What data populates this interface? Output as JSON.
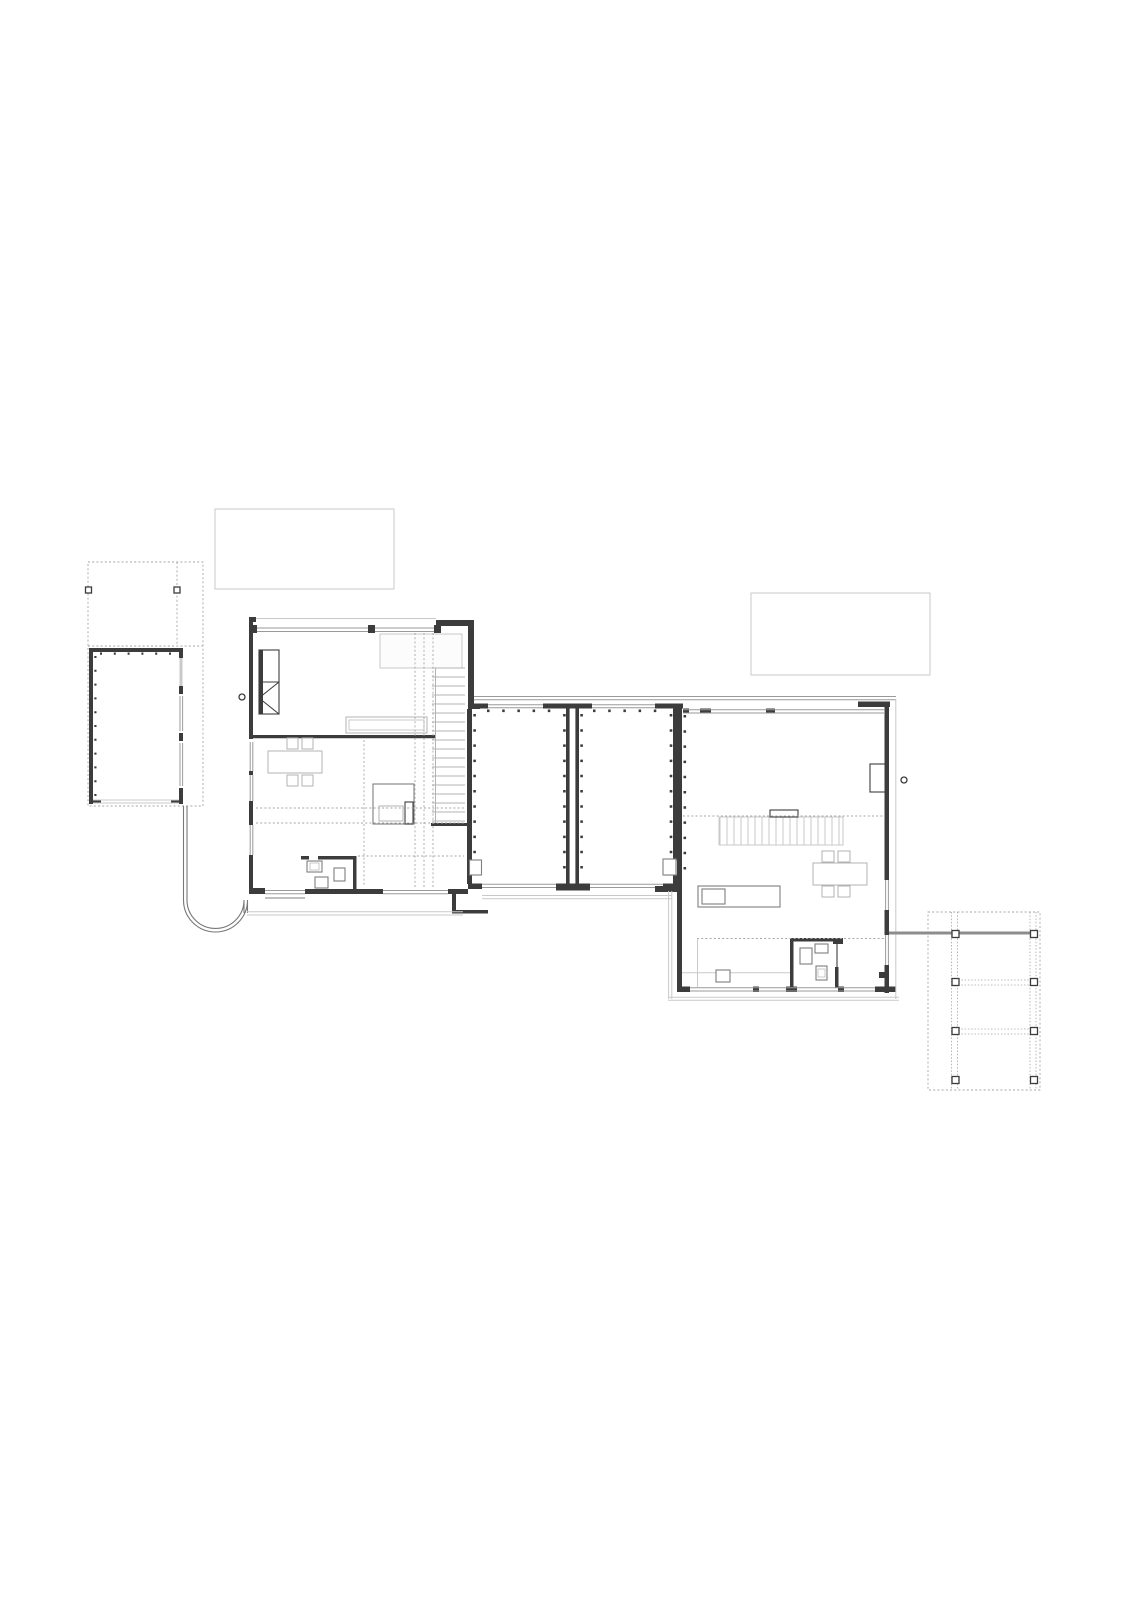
{
  "document": {
    "kind": "architectural-floor-plan",
    "sheet": {
      "width_px": 1131,
      "height_px": 1600,
      "background": "#ffffff"
    },
    "visible_text": []
  },
  "colors": {
    "paper": "#ffffff",
    "wall_dark": "#3c3c3c",
    "wall_medium": "#7f7f7f",
    "glazing": "#9a9a9a",
    "furniture": "#b3b3b3",
    "hairline": "#c9c9c9",
    "dotted": "#a6a6a6",
    "beam": "#8c8c8c",
    "void_fill": "#fcfcfc"
  },
  "plan_elements": {
    "site_structures": [
      {
        "name": "carport-left",
        "style": "dotted canopy outline",
        "posts": 2
      },
      {
        "name": "garage",
        "style": "solid walls with stud ticks",
        "openings": "glazed east side, light south door"
      },
      {
        "name": "curved-garden-wall",
        "style": "u-shaped double line linking garage to west house"
      },
      {
        "name": "roof-rectangle-upper-left",
        "style": "light empty rectangle"
      },
      {
        "name": "roof-rectangle-upper-right",
        "style": "light empty rectangle"
      },
      {
        "name": "pergola-right",
        "style": "dotted canopy outline",
        "posts": 8,
        "beam_to_house": true
      }
    ],
    "buildings": [
      {
        "name": "west-house",
        "features": [
          "fireplace",
          "void-opening",
          "staircase-18-treads",
          "dining-table-4-chairs",
          "counter",
          "desk",
          "wc-room",
          "entry-steps",
          "door-circle-handle"
        ]
      },
      {
        "name": "link-wing",
        "rooms": 2,
        "features": [
          "glazed-north-wall",
          "glazed-south-wall",
          "stud-tick-walls",
          "corner-niches"
        ]
      },
      {
        "name": "east-house",
        "features": [
          "decking-strip-floor",
          "kitchen-island",
          "dining-table-4-chairs",
          "bathroom",
          "storage-area",
          "wall-closet",
          "planter-west",
          "door-circle-handle"
        ]
      }
    ],
    "reference_lines": [
      "section-dotted-verticals-west-house",
      "dotted-line-deck-east-house",
      "dotted-line-bath-east-house"
    ]
  }
}
